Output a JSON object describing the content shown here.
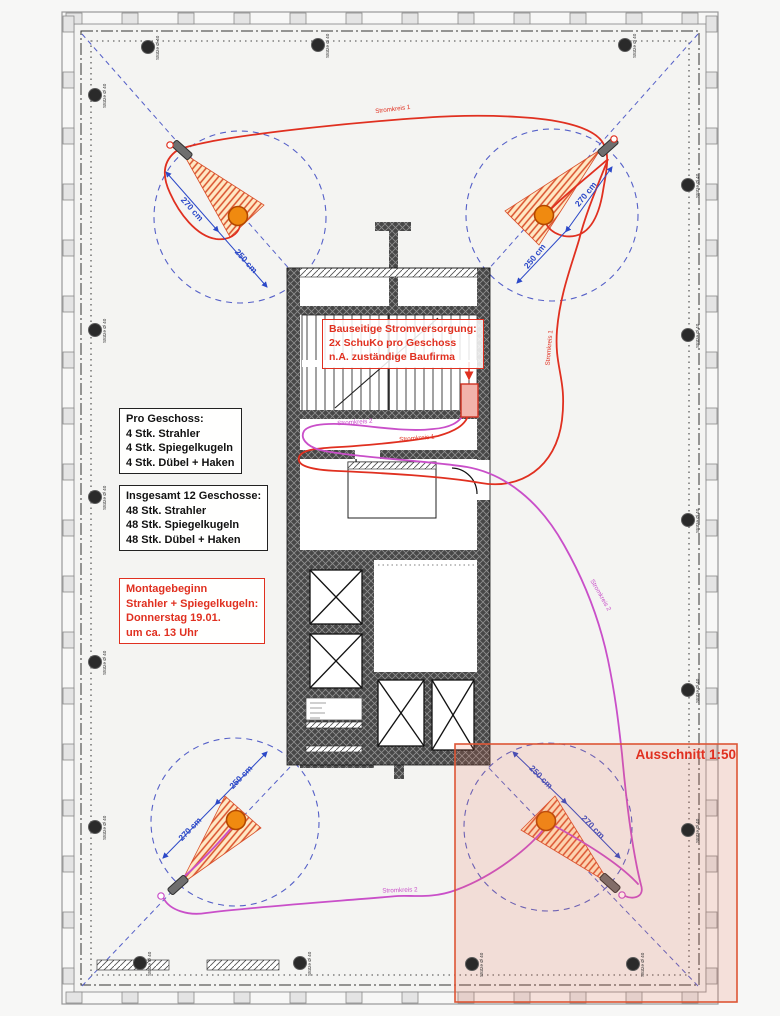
{
  "boxes": {
    "power": {
      "l1": "Bauseitige Stromversorgung:",
      "l2": "2x SchuKo pro Geschoss",
      "l3": "n.A. zuständige Baufirma"
    },
    "per_floor": {
      "l1": "Pro Geschoss:",
      "l2": "4 Stk. Strahler",
      "l3": "4 Stk. Spiegelkugeln",
      "l4": "4 Stk. Dübel + Haken"
    },
    "total": {
      "l1": "Insgesamt 12 Geschosse:",
      "l2": "48 Stk. Strahler",
      "l3": "48 Stk. Spiegelkugeln",
      "l4": "48 Stk. Dübel + Haken"
    },
    "montage": {
      "l1": "Montagebeginn",
      "l2": "Strahler + Spiegelkugeln:",
      "l3": "Donnerstag 19.01.",
      "l4": "um ca. 13 Uhr"
    }
  },
  "labels": {
    "ausschnitt": "Ausschnitt 1:50",
    "circuit1": "Stromkreis 1",
    "circuit2": "Stromkreis 2",
    "column": "Stütze Ø 40",
    "dim270": "270 cm",
    "dim250": "250 cm"
  },
  "colors": {
    "circuit1_red": "#e03020",
    "circuit2_magenta": "#c94fc9",
    "dimension_blue": "#2c49c8",
    "highlight_border": "#dd5535",
    "mirror_ball_orange": "#f08a10"
  }
}
